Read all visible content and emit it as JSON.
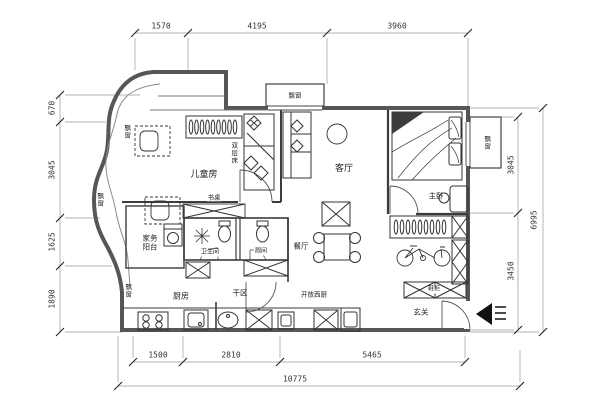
{
  "dimensions": {
    "top": [
      "1570",
      "4195",
      "3960"
    ],
    "left": [
      "670",
      "3045",
      "1625",
      "1890"
    ],
    "right": [
      "3045",
      "3450"
    ],
    "right_total": "6995",
    "bottom": [
      "1500",
      "2810",
      "5465"
    ],
    "bottom_total": "10775"
  },
  "rooms": {
    "children": "儿童房",
    "living": "客厅",
    "master": "主卧",
    "dining": "餐厅",
    "kitchen": "厨房",
    "entry": "玄关",
    "laundry": "家务阳台",
    "bathroom": "卫生间",
    "toilet": "厕间",
    "dry_area": "干区",
    "open_kitchen": "开放西厨"
  },
  "furniture": {
    "bunk_bed": "双层床",
    "desk": "书桌",
    "shoe_cabinet": "鞋柜",
    "bay_window": "飘窗"
  },
  "line_colors": {
    "wall": "#565656",
    "partition": "#3c3c3c",
    "furniture": "#333333",
    "dimension": "#888888"
  }
}
